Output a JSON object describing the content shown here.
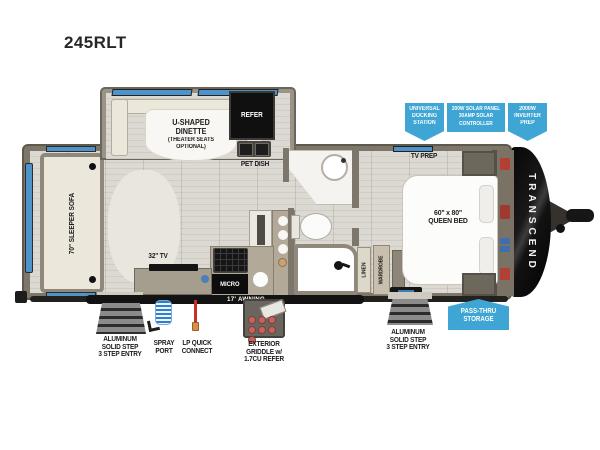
{
  "title": "245RLT",
  "brand": "TRANSCEND",
  "colors": {
    "callout": "#3fa5d4",
    "window": "#4e93c9",
    "ink": "#1b1b1b",
    "wall": "#7d766a",
    "wall-light": "#9a9387",
    "floor": "#dcd9d3",
    "cream": "#ebe7da",
    "counter": "#b3a998",
    "red-line": "#c92f22"
  },
  "callouts": {
    "docking": [
      "UNIVERSAL",
      "DOCKING",
      "STATION"
    ],
    "solar": [
      "200W SOLAR PANEL",
      "30AMP SOLAR",
      "CONTROLLER"
    ],
    "inverter": [
      "2000W",
      "INVERTER",
      "PREP"
    ],
    "passthru": [
      "PASS-THRU",
      "STORAGE"
    ]
  },
  "interior": {
    "dinette": [
      "U-SHAPED",
      "DINETTE",
      "(THEATER SEATS",
      "OPTIONAL)"
    ],
    "refer": "REFER",
    "pet_dish": "PET DISH",
    "sofa": "70\" SLEEPER SOFA",
    "tv": "32\" TV",
    "micro": "MICRO",
    "tv_prep": "TV PREP",
    "bed": [
      "60\" x 80\"",
      "QUEEN BED"
    ],
    "wardrobe": "WARDROBE",
    "linen": "LINEN"
  },
  "exterior": {
    "awning": "17' AWNING",
    "step_left": [
      "ALUMINUM",
      "SOLID STEP",
      "3 STEP ENTRY"
    ],
    "spray": [
      "SPRAY",
      "PORT"
    ],
    "lp": [
      "LP QUICK",
      "CONNECT"
    ],
    "griddle": [
      "EXTERIOR",
      "GRIDDLE w/",
      "1.7CU REFER"
    ],
    "step_right": [
      "ALUMINUM",
      "SOLID STEP",
      "3 STEP ENTRY"
    ]
  }
}
